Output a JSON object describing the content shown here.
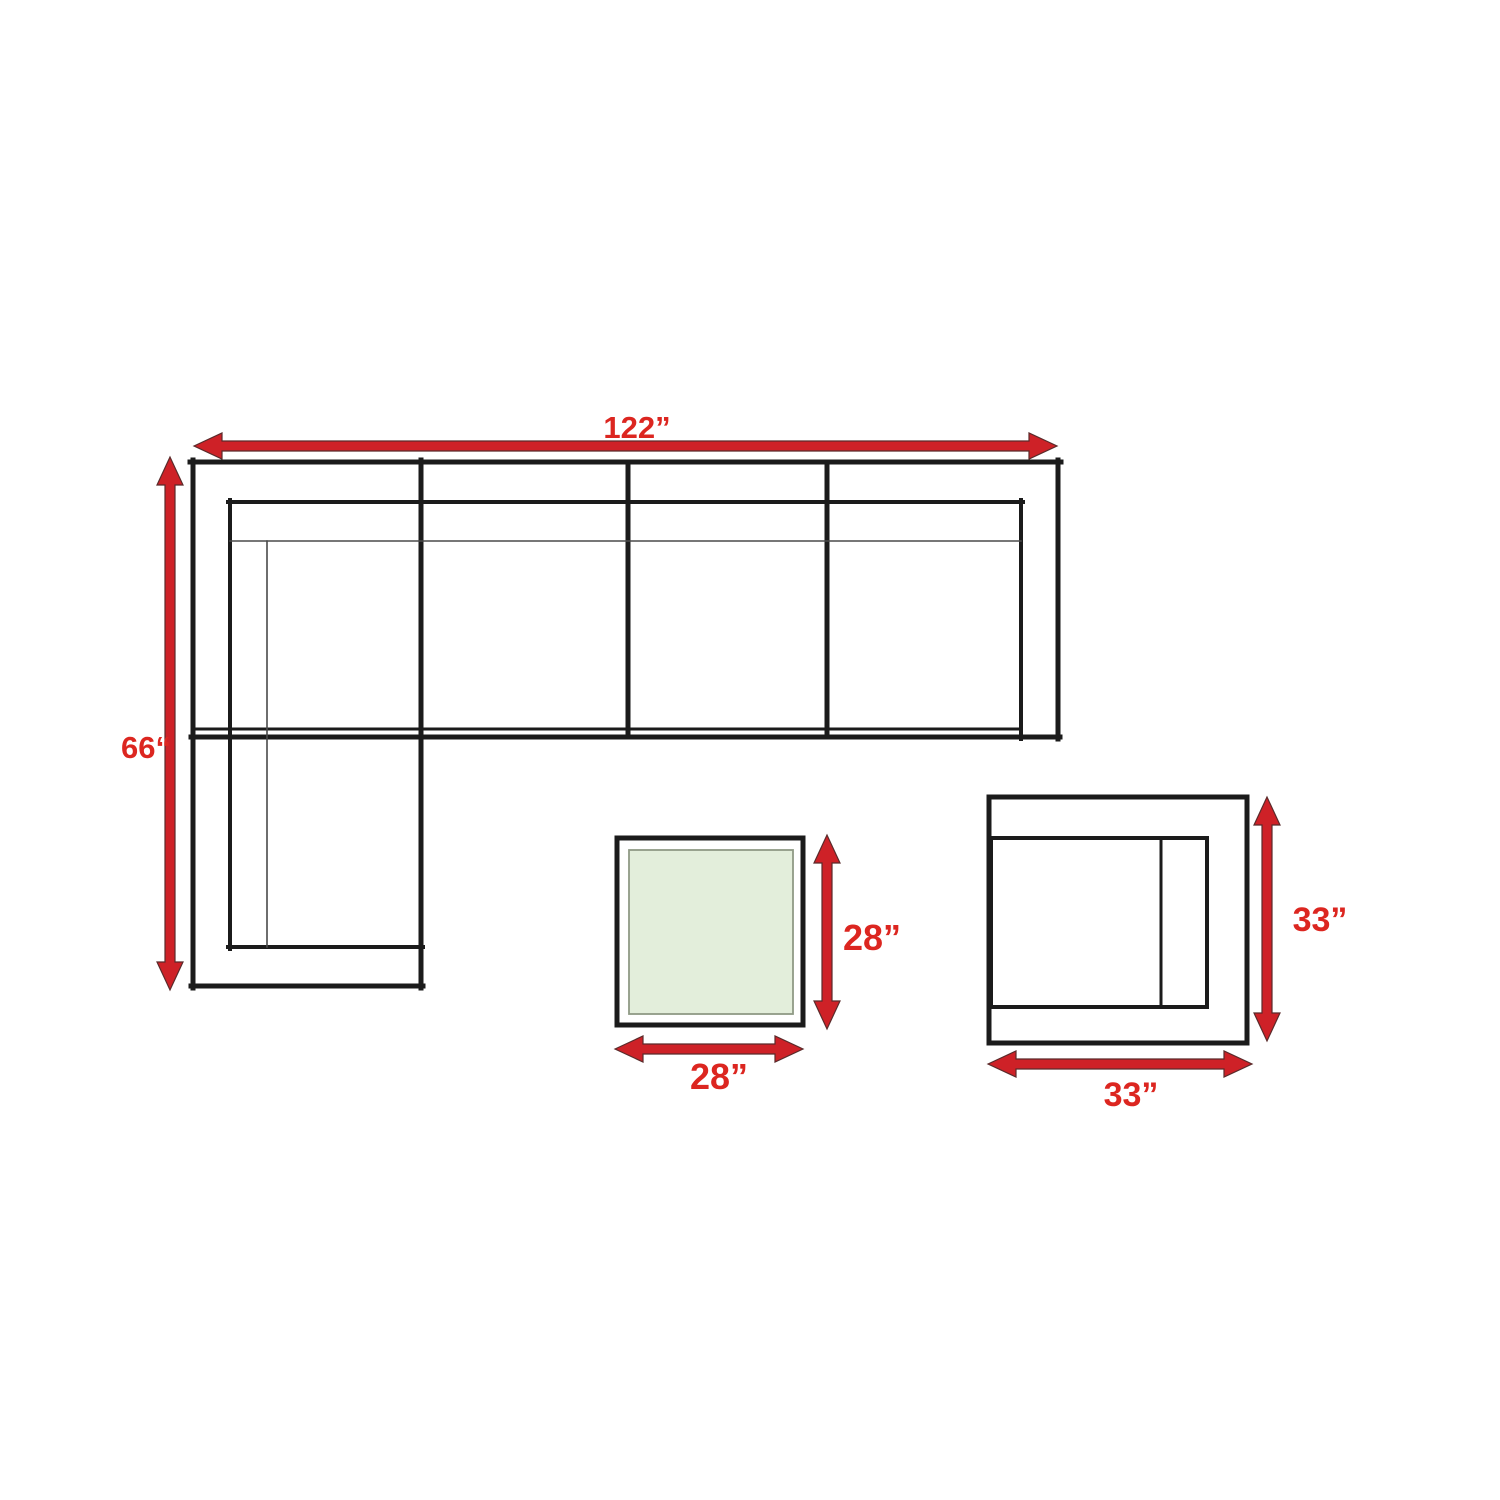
{
  "diagram": {
    "kind": "furniture-dimension-plan",
    "pieces": [
      "sectional-sofa",
      "coffee-table",
      "side-chair"
    ]
  },
  "sofa": {
    "width_label": "122”",
    "depth_label": "66“"
  },
  "coffee_table": {
    "depth_label": "28”",
    "width_label": "28”"
  },
  "side_chair": {
    "depth_label": "33”",
    "width_label": "33”"
  },
  "colors": {
    "background": "#ffffff",
    "outline_black": "#1b1b1b",
    "dimension_red": "#ce2127",
    "label_red": "#dc2620",
    "table_top_green": "#e3eedb",
    "table_top_border": "#8f9a85"
  }
}
